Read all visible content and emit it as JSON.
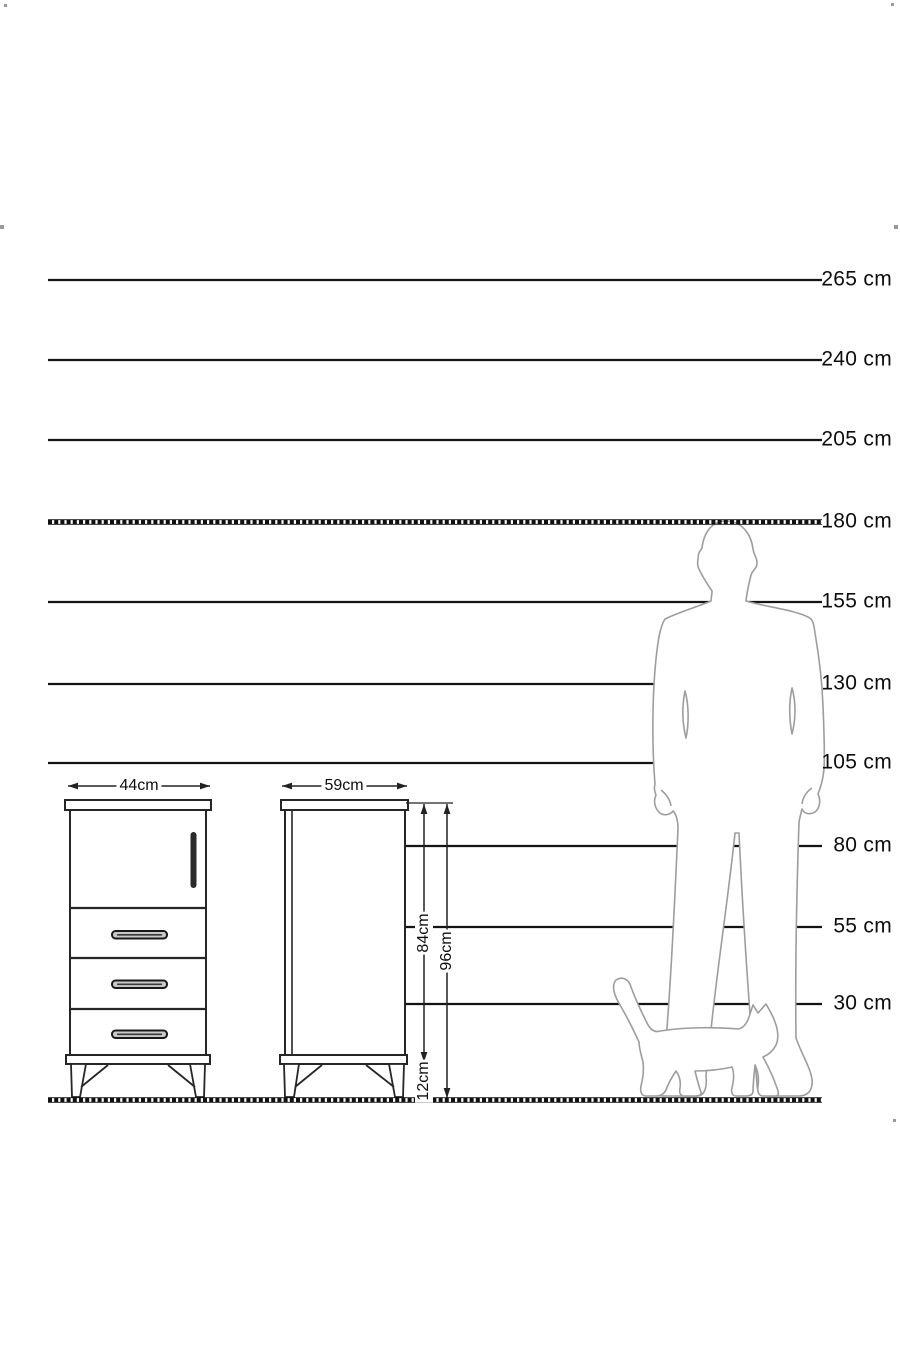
{
  "ruler": {
    "unit": "cm",
    "labels": [
      "265 cm",
      "240 cm",
      "205 cm",
      "180 cm",
      "155 cm",
      "130 cm",
      "105 cm",
      "80 cm",
      "55 cm",
      "30 cm"
    ]
  },
  "cabinet": {
    "front_width": "44cm",
    "side_depth": "59cm",
    "carcass_height": "84cm",
    "total_height": "96cm",
    "leg_height": "12cm"
  },
  "colors": {
    "reference_line": "#141414",
    "cabinet_line": "#262626",
    "silhouette_line": "#9d9d9d",
    "background": "#ffffff"
  }
}
